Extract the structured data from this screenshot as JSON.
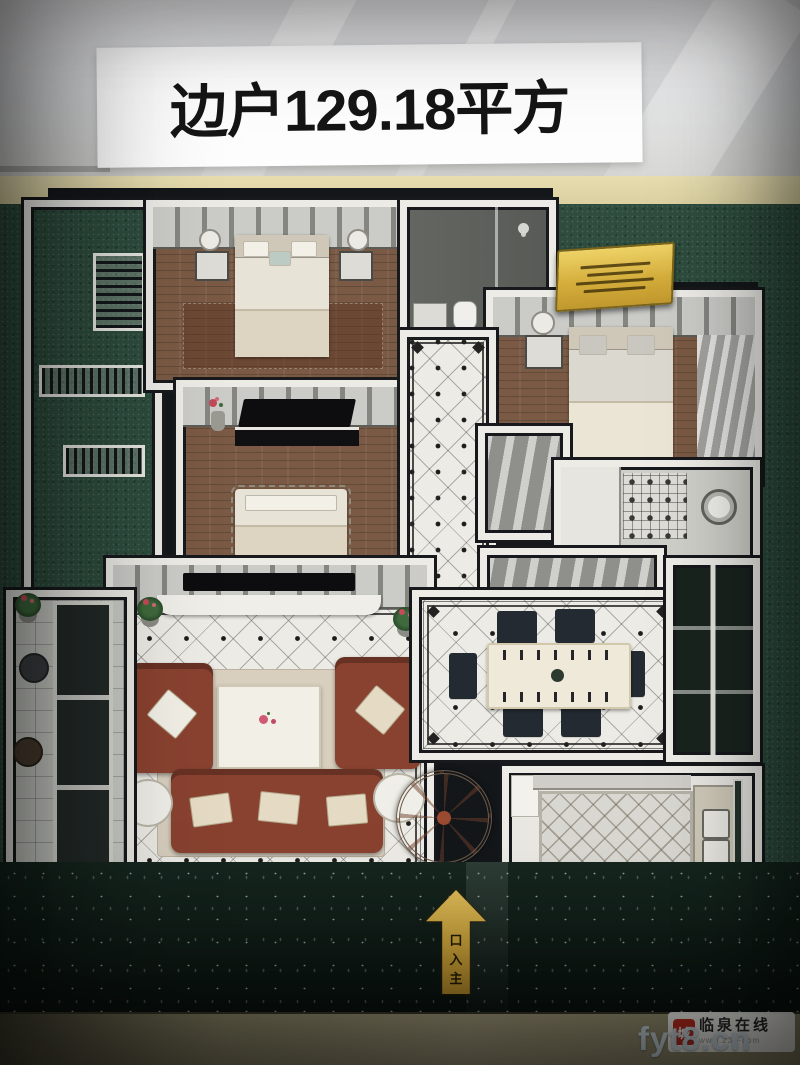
{
  "banner": {
    "text": "边户129.18平方"
  },
  "model": {
    "rooms_visible": [
      "master-bedroom",
      "bedroom",
      "bedroom",
      "bathroom",
      "laundry-bathroom",
      "hallway",
      "living-room",
      "dining-room",
      "kitchen",
      "balcony",
      "balcony"
    ],
    "entrance_arrow": {
      "label": "主入口",
      "chars_top_to_bottom": [
        "口",
        "入",
        "主"
      ]
    }
  },
  "watermark": {
    "seal_char": "城",
    "site_name": "临泉在线",
    "partial_url": "www.23⋯com",
    "overlay_url": "fyt8.cn"
  },
  "colors": {
    "banner_bg": "#fdfdfd",
    "banner_text": "#151515",
    "turf_green": "#2e4d3e",
    "plaque_gold": "#d4ae3c",
    "arrow_gold": "#c39b35",
    "sofa_brown": "#8a4230",
    "wood_floor": "#7a5a44",
    "tile_floor": "#edebe5",
    "seal_red": "#c03020",
    "watermark_overlay": "#d6e5ee"
  }
}
